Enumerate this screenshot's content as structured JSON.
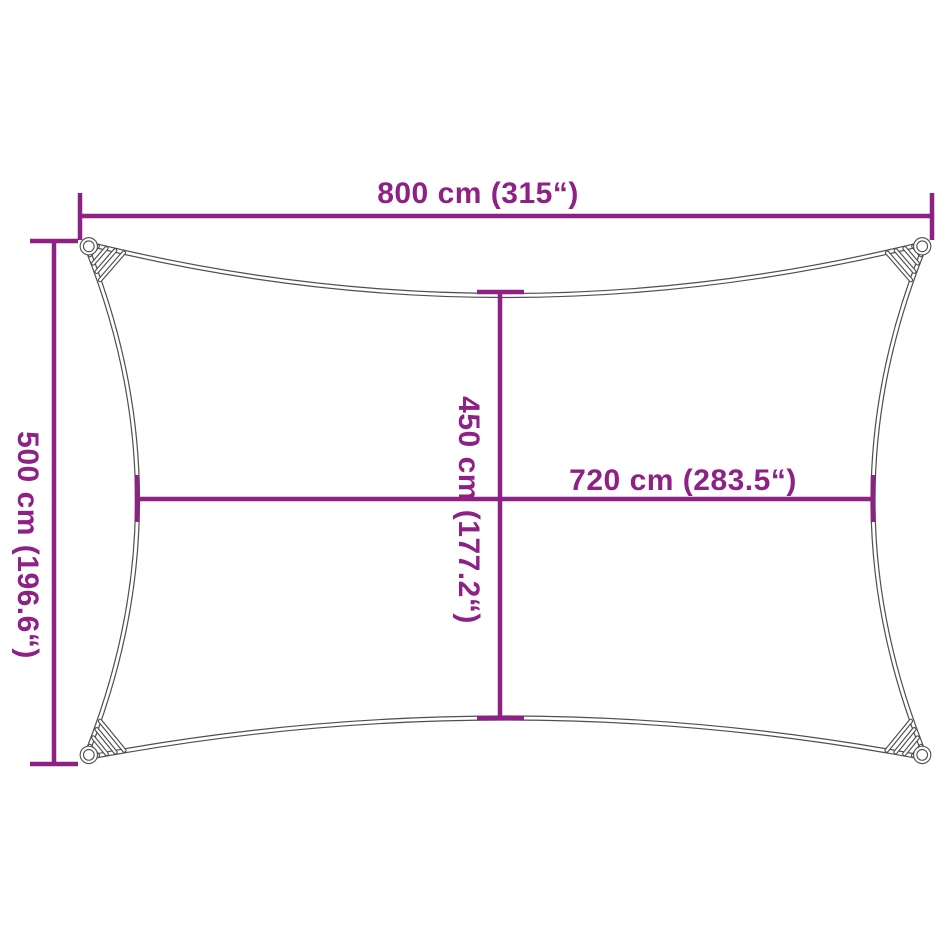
{
  "diagram": {
    "kind": "shade-sail-dimension-diagram",
    "dimensions": {
      "outer_width": {
        "cm": 800,
        "inches": 315,
        "text": "800 cm (315“)"
      },
      "outer_height": {
        "cm": 500,
        "inches": 196.6,
        "text": "500 cm (196.6“)"
      },
      "inner_height": {
        "cm": 450,
        "inches": 177.2,
        "text": "450 cm (177.2“)"
      },
      "inner_width": {
        "cm": 720,
        "inches": 283.5,
        "text": "720 cm (283.5“)"
      }
    },
    "colors": {
      "dimension_line": "#8e2186",
      "sail_outline": "#4f4f4f",
      "background": "#ffffff"
    }
  }
}
